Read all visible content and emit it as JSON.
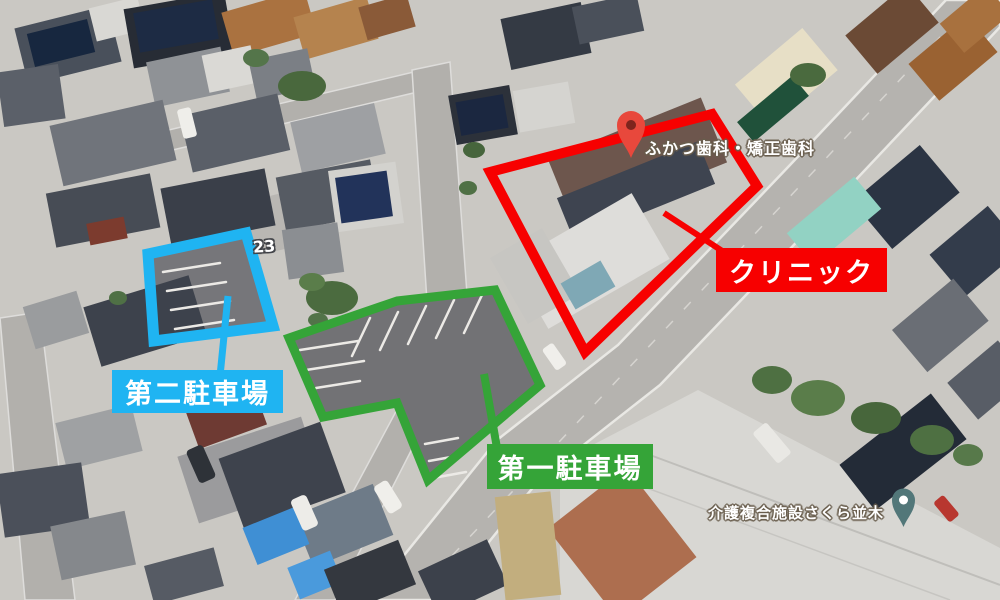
{
  "annotations": {
    "clinic": {
      "label": "クリニック"
    },
    "parking_second": {
      "label": "第二駐車場"
    },
    "parking_first": {
      "label": "第一駐車場"
    }
  },
  "map_labels": {
    "dental_clinic": "ふかつ歯科・矯正歯科",
    "care_facility": "介護複合施設さくら並木",
    "route_number": "23"
  },
  "colors": {
    "clinic-red": "#f70000",
    "parking2-blue": "#1fb4f2",
    "parking1-green": "#35a438",
    "dental-pin-red": "#e8483c",
    "dental-pin-hole": "#7e241d",
    "care-pin-teal": "#527779"
  }
}
